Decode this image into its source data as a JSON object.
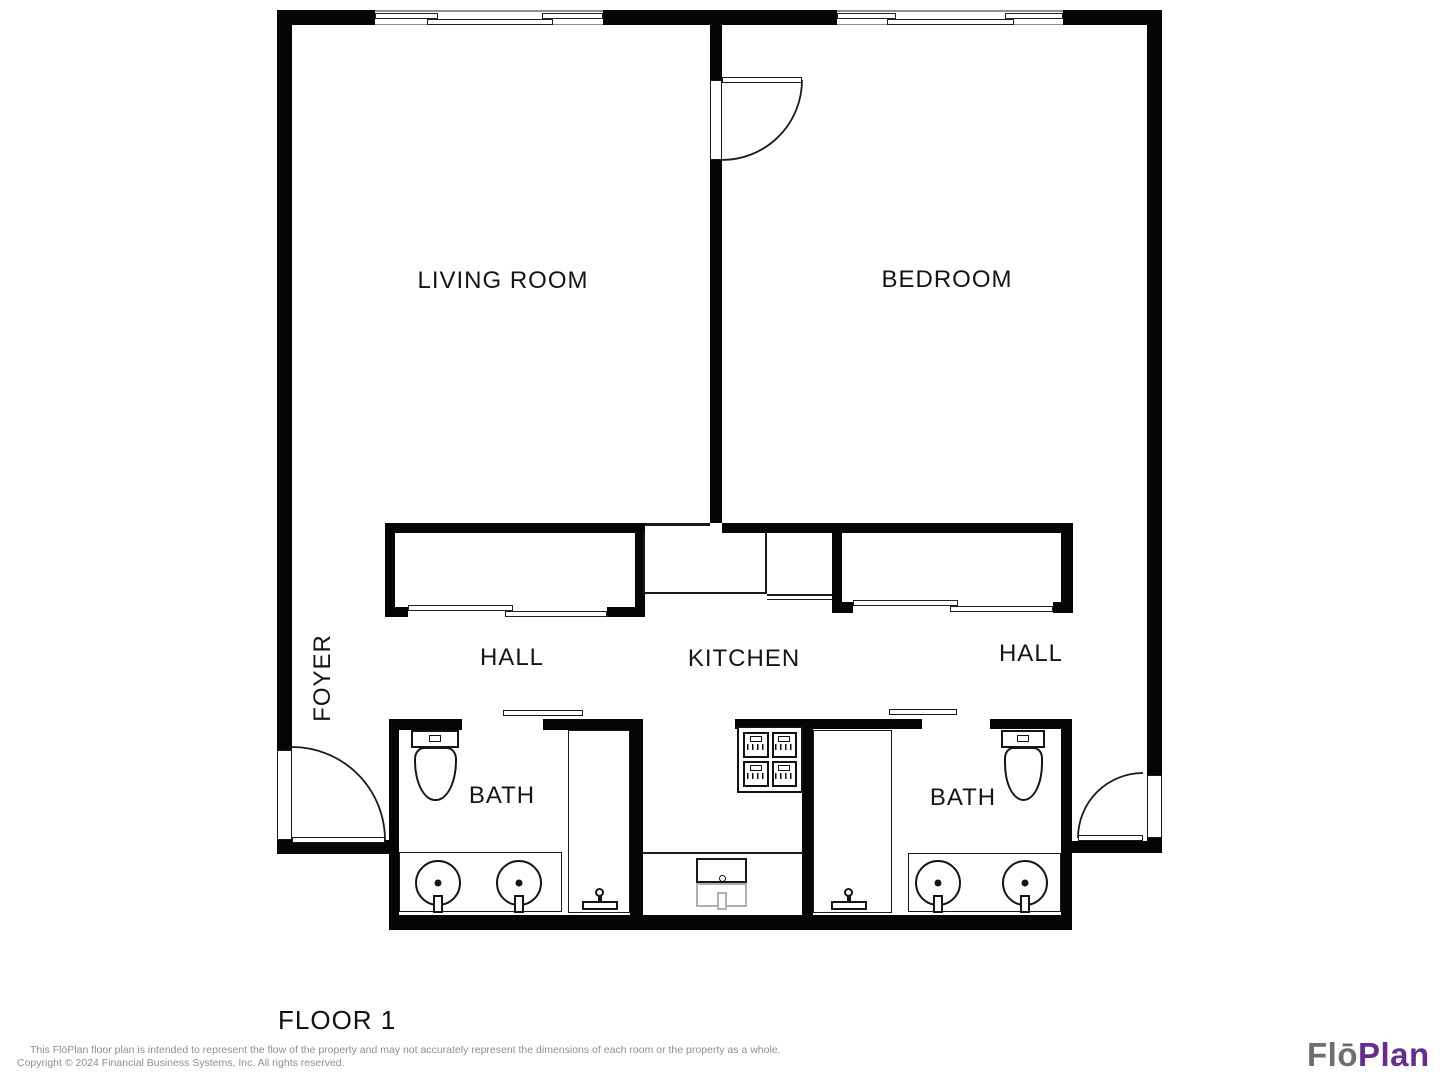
{
  "plan": {
    "rooms": {
      "living_room": "LIVING ROOM",
      "bedroom": "BEDROOM",
      "hall_left": "HALL",
      "kitchen": "KITCHEN",
      "hall_right": "HALL",
      "foyer": "FOYER",
      "bath_left": "BATH",
      "bath_right": "BATH"
    },
    "floor_label": "FLOOR 1",
    "fixtures": [
      "toilet",
      "double-sink-vanity",
      "shower",
      "sliding-door-closet",
      "stove",
      "kitchen-sink",
      "pocket-door",
      "hinged-door",
      "sliding-window"
    ]
  },
  "footer": {
    "disclaimer_line1": "This FlōPlan floor plan is intended to represent the flow of the property and may not accurately represent the dimensions of each room or the property as a whole.",
    "disclaimer_line2": "Copyright © 2024 Financial Business Systems, Inc. All rights reserved."
  },
  "branding": {
    "logo_text_gray": "Flō",
    "logo_text_purple": "Plan"
  },
  "colors": {
    "wall": "#050505",
    "line": "#1a1a1a",
    "background": "#ffffff",
    "disclaimer": "#8f8f8f",
    "logo_gray": "#6d6e71",
    "logo_purple": "#662d91"
  }
}
